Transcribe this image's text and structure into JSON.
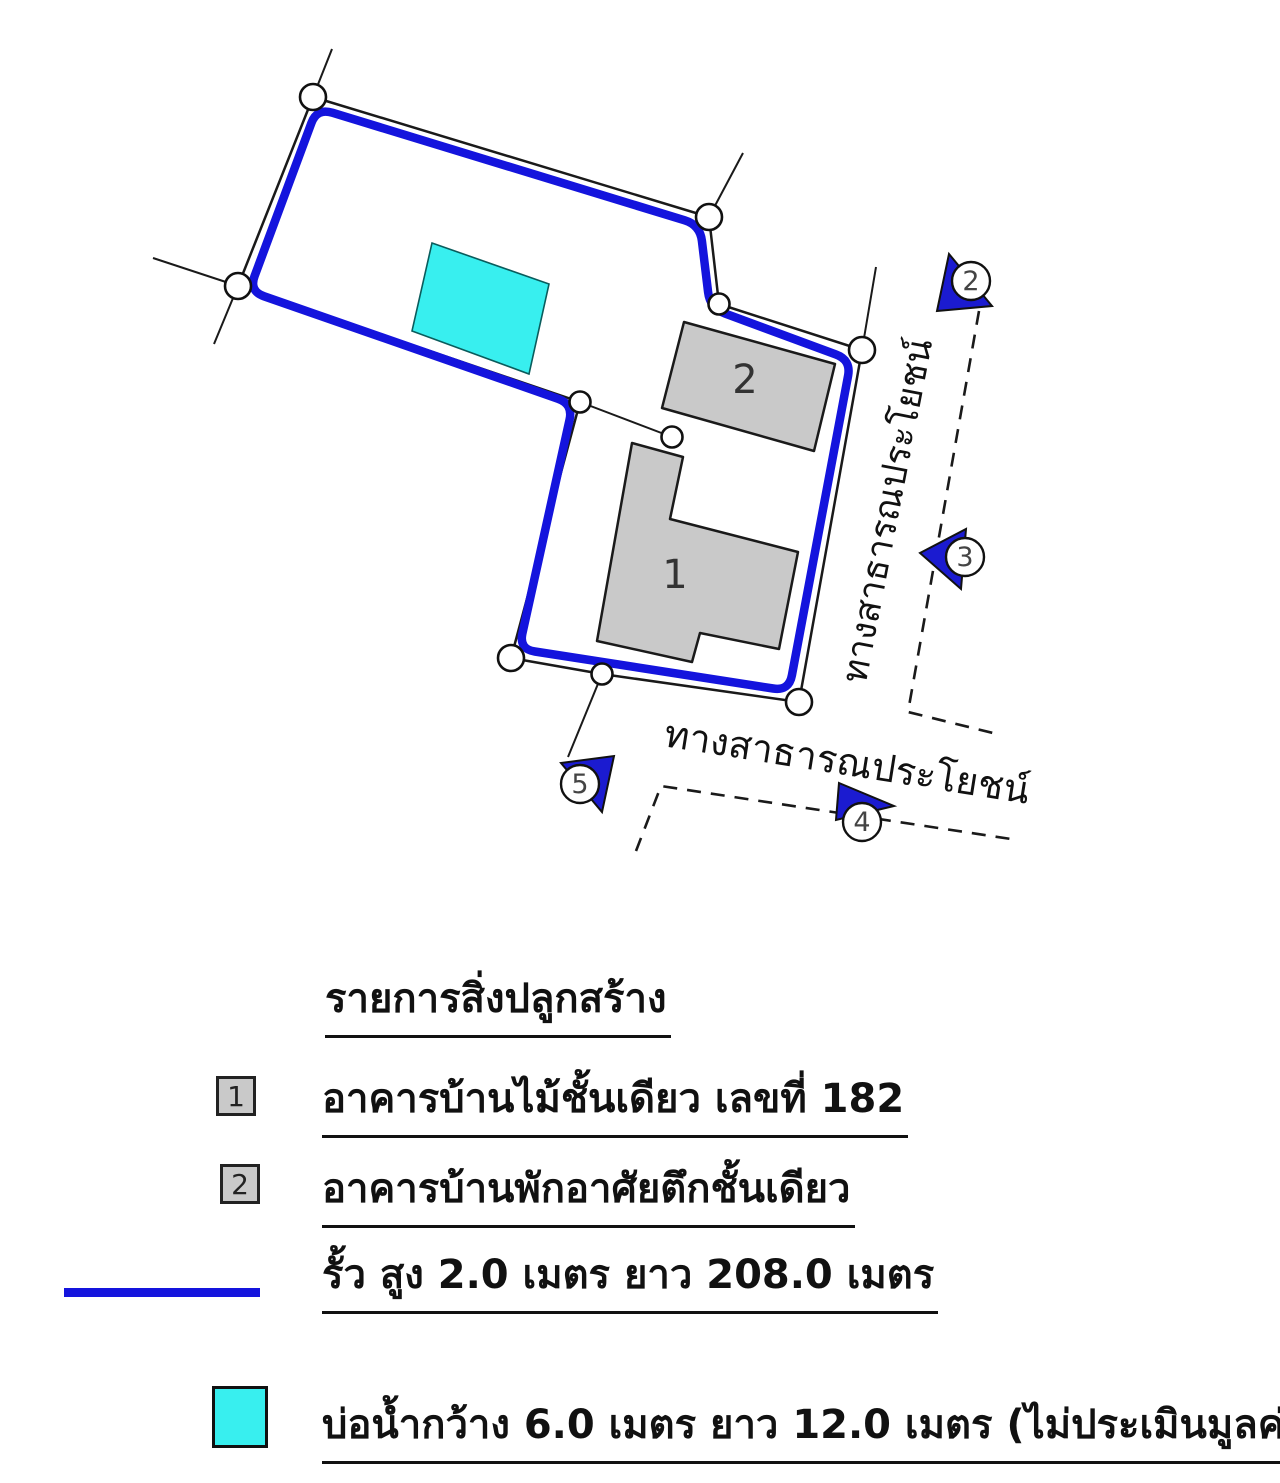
{
  "colors": {
    "fence": "#1414dd",
    "marker": "#1b1bd0",
    "building": "#c9c9c9",
    "pond": "#38efef",
    "line": "#1a1a1a",
    "label": "#333333"
  },
  "map": {
    "boundary": [
      [
        313,
        97
      ],
      [
        709,
        217
      ],
      [
        719,
        304
      ],
      [
        862,
        350
      ],
      [
        799,
        702
      ],
      [
        602,
        674
      ],
      [
        511,
        658
      ],
      [
        580,
        402
      ],
      [
        238,
        286
      ]
    ],
    "fence": [
      [
        317,
        108
      ],
      [
        700,
        225
      ],
      [
        710,
        308
      ],
      [
        851,
        360
      ],
      [
        789,
        691
      ],
      [
        519,
        649
      ],
      [
        573,
        404
      ],
      [
        249,
        291
      ]
    ],
    "fence_width": 8.5,
    "corner_radius": 16,
    "ext_lines": [
      [
        313,
        97,
        332,
        49
      ],
      [
        709,
        217,
        743,
        153
      ],
      [
        862,
        350,
        876,
        267
      ],
      [
        238,
        286,
        153,
        258
      ],
      [
        238,
        286,
        214,
        344
      ],
      [
        602,
        674,
        568,
        757
      ],
      [
        580,
        402,
        672,
        437
      ]
    ],
    "circles": [
      [
        313,
        97,
        13
      ],
      [
        709,
        217,
        13
      ],
      [
        862,
        350,
        13
      ],
      [
        799,
        702,
        13
      ],
      [
        511,
        658,
        13
      ],
      [
        238,
        286,
        13
      ],
      [
        719,
        304,
        10.5
      ],
      [
        602,
        674,
        10.5
      ],
      [
        580,
        402,
        10.5
      ],
      [
        672,
        437,
        10.5
      ]
    ],
    "pond": [
      [
        432,
        243
      ],
      [
        549,
        284
      ],
      [
        529,
        374
      ],
      [
        412,
        331
      ]
    ],
    "buildings": [
      {
        "label": "1",
        "points": [
          [
            632,
            443
          ],
          [
            683,
            457
          ],
          [
            670,
            519
          ],
          [
            798,
            552
          ],
          [
            779,
            649
          ],
          [
            700,
            633
          ],
          [
            692,
            662
          ],
          [
            597,
            641
          ]
        ],
        "lx": 675,
        "ly": 588
      },
      {
        "label": "2",
        "points": [
          [
            684,
            322
          ],
          [
            835,
            364
          ],
          [
            814,
            451
          ],
          [
            662,
            408
          ]
        ],
        "lx": 745,
        "ly": 393
      }
    ],
    "roads": [
      [
        [
          979,
          311
        ],
        [
          908,
          712
        ],
        [
          997,
          734
        ]
      ],
      [
        [
          636,
          851
        ],
        [
          661,
          786
        ],
        [
          1011,
          839
        ]
      ]
    ],
    "road_labels": [
      {
        "text": "ทางสาธารณประโยชน์",
        "x": 899,
        "y": 513,
        "rot": -79,
        "size": 36
      },
      {
        "text": "ทางสาธารณประโยชน์",
        "x": 845,
        "y": 775,
        "rot": 9,
        "size": 38
      }
    ],
    "markers": [
      {
        "label": "2",
        "tri": [
          [
            937,
            311
          ],
          [
            949,
            254
          ],
          [
            992,
            306
          ]
        ],
        "cx": 971,
        "cy": 281
      },
      {
        "label": "3",
        "tri": [
          [
            920,
            553
          ],
          [
            966,
            529
          ],
          [
            961,
            589
          ]
        ],
        "cx": 965,
        "cy": 557
      },
      {
        "label": "4",
        "tri": [
          [
            839,
            783
          ],
          [
            894,
            806
          ],
          [
            836,
            820
          ]
        ],
        "cx": 862,
        "cy": 822
      },
      {
        "label": "5",
        "tri": [
          [
            561,
            763
          ],
          [
            614,
            756
          ],
          [
            602,
            812
          ]
        ],
        "cx": 580,
        "cy": 784
      }
    ],
    "marker_r": 19
  },
  "legend": {
    "title": "รายการสิ่งปลูกสร้าง",
    "rows": [
      {
        "num": "1",
        "text": "อาคารบ้านไม้ชั้นเดียว เลขที่ 182"
      },
      {
        "num": "2",
        "text": "อาคารบ้านพักอาศัยตึกชั้นเดียว"
      },
      {
        "text": "รั้ว สูง 2.0 เมตร ยาว 208.0 เมตร"
      },
      {
        "text": "บ่อน้ำกว้าง 6.0 เมตร ยาว 12.0 เมตร (ไม่ประเมินมูลค่า)"
      }
    ]
  }
}
